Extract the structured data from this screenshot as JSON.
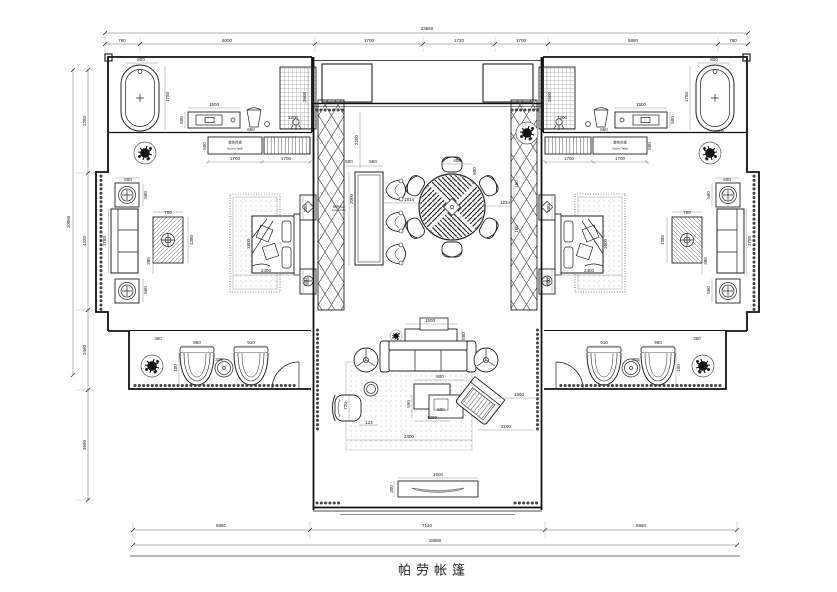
{
  "title_block": {
    "title": "帕劳帐篷"
  },
  "furniture_labels": {
    "accent_table_cn": "装饰台桌",
    "accent_table_en": "Accent Table"
  },
  "dimensions": {
    "top": {
      "overall": "23660",
      "segments": [
        "780",
        "6000",
        "1700",
        "1720",
        "1700",
        "5880",
        "780"
      ]
    },
    "left": {
      "overall": "10060",
      "segments": [
        "2280",
        "4320",
        "3460",
        "3680"
      ]
    },
    "bottom": {
      "overall": "18880",
      "segments": [
        "5880",
        "7120",
        "5880"
      ]
    }
  },
  "annotations": [
    {
      "t": "23660",
      "x": 427,
      "y": 29
    },
    {
      "t": "780",
      "x": 122,
      "y": 41
    },
    {
      "t": "6000",
      "x": 227,
      "y": 41
    },
    {
      "t": "1700",
      "x": 369,
      "y": 41
    },
    {
      "t": "1720",
      "x": 459,
      "y": 41
    },
    {
      "t": "1700",
      "x": 521,
      "y": 41
    },
    {
      "t": "5880",
      "x": 633,
      "y": 41
    },
    {
      "t": "780",
      "x": 733,
      "y": 41
    },
    {
      "t": "10060",
      "x": 69,
      "y": 222,
      "r": -90
    },
    {
      "t": "2280",
      "x": 85,
      "y": 121,
      "r": -90
    },
    {
      "t": "4320",
      "x": 85,
      "y": 241,
      "r": -90
    },
    {
      "t": "3460",
      "x": 85,
      "y": 350,
      "r": -90
    },
    {
      "t": "3680",
      "x": 85,
      "y": 445,
      "r": -90
    },
    {
      "t": "5880",
      "x": 221,
      "y": 526
    },
    {
      "t": "7120",
      "x": 427,
      "y": 526
    },
    {
      "t": "5880",
      "x": 641,
      "y": 526
    },
    {
      "t": "18880",
      "x": 435,
      "y": 541
    },
    {
      "t": "800",
      "x": 141,
      "y": 60
    },
    {
      "t": "1750",
      "x": 168,
      "y": 97,
      "r": -90
    },
    {
      "t": "1500",
      "x": 214,
      "y": 105
    },
    {
      "t": "500",
      "x": 182,
      "y": 120,
      "r": -90
    },
    {
      "t": "650",
      "x": 251,
      "y": 130
    },
    {
      "t": "2600",
      "x": 305,
      "y": 97,
      "r": -90
    },
    {
      "t": "1200",
      "x": 293,
      "y": 118
    },
    {
      "t": "500",
      "x": 205,
      "y": 146,
      "r": -90
    },
    {
      "t": "1700",
      "x": 235,
      "y": 159
    },
    {
      "t": "1700",
      "x": 286,
      "y": 159
    },
    {
      "t": "装饰台桌",
      "x": 235,
      "y": 143,
      "s": 3.4
    },
    {
      "t": "Accent Table",
      "x": 235,
      "y": 149,
      "s": 2.8
    },
    {
      "t": "600",
      "x": 128,
      "y": 180
    },
    {
      "t": "560",
      "x": 146,
      "y": 195,
      "r": -90
    },
    {
      "t": "2780",
      "x": 105,
      "y": 241,
      "r": -90
    },
    {
      "t": "700",
      "x": 168,
      "y": 213
    },
    {
      "t": "1380",
      "x": 192,
      "y": 240,
      "r": -90
    },
    {
      "t": "380",
      "x": 149,
      "y": 261,
      "r": -90
    },
    {
      "t": "560",
      "x": 146,
      "y": 290,
      "r": -90
    },
    {
      "t": "1800",
      "x": 249,
      "y": 244,
      "r": -90
    },
    {
      "t": "2400",
      "x": 266,
      "y": 271
    },
    {
      "t": "500",
      "x": 306,
      "y": 208,
      "r": -90
    },
    {
      "t": "500",
      "x": 306,
      "y": 282,
      "r": -90
    },
    {
      "t": "360",
      "x": 158,
      "y": 339
    },
    {
      "t": "960",
      "x": 197,
      "y": 343
    },
    {
      "t": "325",
      "x": 219,
      "y": 360
    },
    {
      "t": "910",
      "x": 251,
      "y": 343
    },
    {
      "t": "100",
      "x": 176,
      "y": 368,
      "r": -90
    },
    {
      "t": "800",
      "x": 714,
      "y": 60
    },
    {
      "t": "1750",
      "x": 687,
      "y": 97,
      "r": -90
    },
    {
      "t": "1500",
      "x": 641,
      "y": 105
    },
    {
      "t": "500",
      "x": 673,
      "y": 120,
      "r": -90
    },
    {
      "t": "650",
      "x": 604,
      "y": 130
    },
    {
      "t": "2600",
      "x": 550,
      "y": 97,
      "r": -90
    },
    {
      "t": "1200",
      "x": 562,
      "y": 118
    },
    {
      "t": "1000",
      "x": 719,
      "y": 132
    },
    {
      "t": "500",
      "x": 650,
      "y": 146,
      "r": -90
    },
    {
      "t": "1700",
      "x": 620,
      "y": 159
    },
    {
      "t": "1700",
      "x": 569,
      "y": 159
    },
    {
      "t": "装饰台桌",
      "x": 620,
      "y": 143,
      "s": 3.4
    },
    {
      "t": "Accent Table",
      "x": 620,
      "y": 149,
      "s": 2.8
    },
    {
      "t": "600",
      "x": 727,
      "y": 180
    },
    {
      "t": "560",
      "x": 709,
      "y": 195,
      "r": -90
    },
    {
      "t": "2780",
      "x": 750,
      "y": 241,
      "r": -90
    },
    {
      "t": "700",
      "x": 687,
      "y": 213
    },
    {
      "t": "1380",
      "x": 663,
      "y": 240,
      "r": -90
    },
    {
      "t": "380",
      "x": 706,
      "y": 261,
      "r": -90
    },
    {
      "t": "560",
      "x": 709,
      "y": 290,
      "r": -90
    },
    {
      "t": "1800",
      "x": 606,
      "y": 244,
      "r": -90
    },
    {
      "t": "2400",
      "x": 589,
      "y": 271
    },
    {
      "t": "500",
      "x": 549,
      "y": 208,
      "r": -90
    },
    {
      "t": "500",
      "x": 549,
      "y": 282,
      "r": -90
    },
    {
      "t": "360",
      "x": 697,
      "y": 339
    },
    {
      "t": "960",
      "x": 658,
      "y": 343
    },
    {
      "t": "325",
      "x": 636,
      "y": 360
    },
    {
      "t": "910",
      "x": 604,
      "y": 343
    },
    {
      "t": "100",
      "x": 679,
      "y": 368,
      "r": -90
    },
    {
      "t": "2200",
      "x": 357,
      "y": 140,
      "r": -90
    },
    {
      "t": "500",
      "x": 349,
      "y": 162
    },
    {
      "t": "550",
      "x": 373,
      "y": 162
    },
    {
      "t": "2000",
      "x": 352,
      "y": 199,
      "r": -90
    },
    {
      "t": "装饰台桌",
      "x": 339,
      "y": 207,
      "s": 3
    },
    {
      "t": "Accent Table",
      "x": 339,
      "y": 211,
      "s": 2.5
    },
    {
      "t": "1814",
      "x": 409,
      "y": 200
    },
    {
      "t": "400",
      "x": 457,
      "y": 161
    },
    {
      "t": "600",
      "x": 475,
      "y": 171,
      "r": -90
    },
    {
      "t": "1234",
      "x": 505,
      "y": 203
    },
    {
      "t": "160",
      "x": 517,
      "y": 184,
      "r": -90
    },
    {
      "t": "160",
      "x": 517,
      "y": 229,
      "r": -90
    },
    {
      "t": "1500",
      "x": 430,
      "y": 321
    },
    {
      "t": "500",
      "x": 464,
      "y": 336,
      "r": -90
    },
    {
      "t": "900",
      "x": 440,
      "y": 377
    },
    {
      "t": "550",
      "x": 409,
      "y": 404,
      "r": -90
    },
    {
      "t": "500",
      "x": 441,
      "y": 410
    },
    {
      "t": "1200",
      "x": 432,
      "y": 418
    },
    {
      "t": "720",
      "x": 346,
      "y": 406,
      "r": -90
    },
    {
      "t": "124",
      "x": 369,
      "y": 423
    },
    {
      "t": "1390",
      "x": 519,
      "y": 395
    },
    {
      "t": "2190",
      "x": 506,
      "y": 427
    },
    {
      "t": "2400",
      "x": 409,
      "y": 437
    },
    {
      "t": "1600",
      "x": 438,
      "y": 475
    },
    {
      "t": "350",
      "x": 392,
      "y": 489,
      "r": -90
    }
  ]
}
